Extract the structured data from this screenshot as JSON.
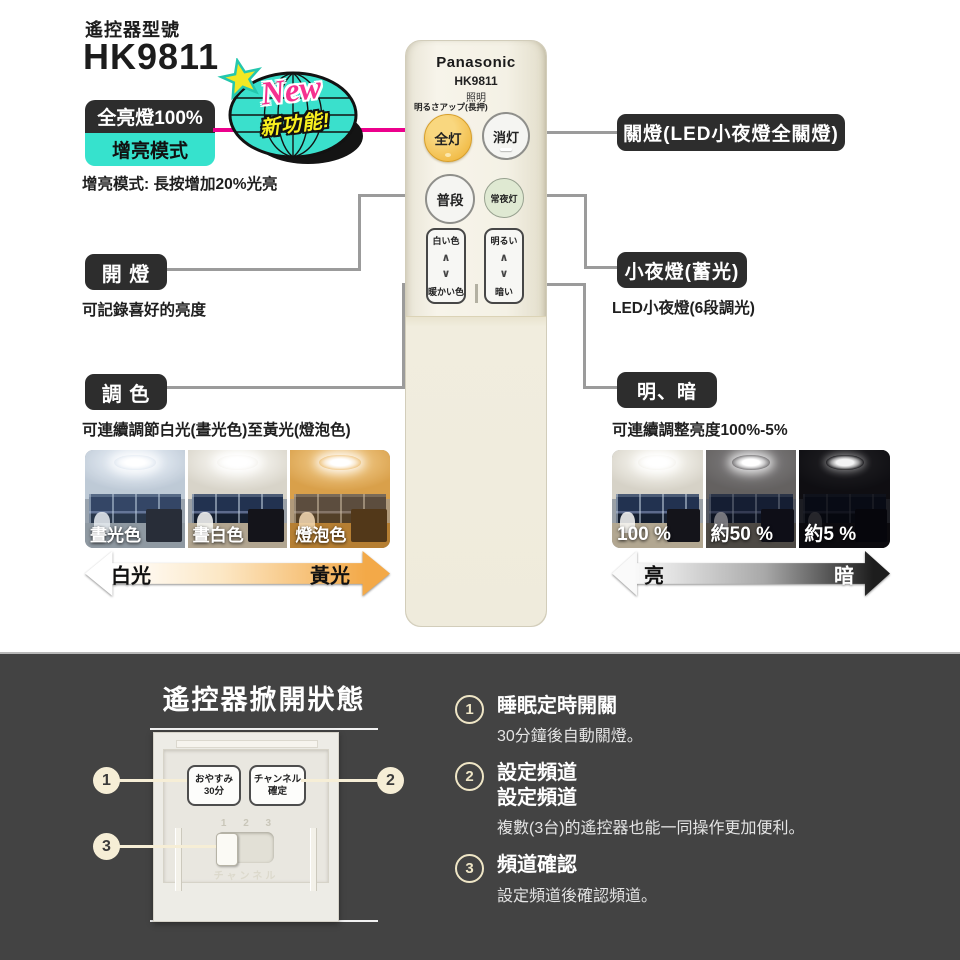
{
  "header": {
    "model_label": "遙控器型號",
    "model": "HK9811"
  },
  "new_badge": {
    "new_text": "New",
    "feature_text": "新功能!"
  },
  "left_callouts": {
    "full_light": "全亮燈100%",
    "boost_mode": "增亮模式",
    "boost_note": "增亮模式: 長按增加20%光亮",
    "on_label": "開 燈",
    "on_note": "可記錄喜好的亮度",
    "tone_label": "調 色",
    "tone_note": "可連續調節白光(晝光色)至黃光(燈泡色)",
    "photo_labels": [
      "晝光色",
      "晝白色",
      "燈泡色"
    ],
    "arrow_start": "白光",
    "arrow_end": "黃光"
  },
  "right_callouts": {
    "off_label": "關燈(LED小夜燈全關燈)",
    "night_label": "小夜燈(蓄光)",
    "night_note": "LED小夜燈(6段調光)",
    "dim_label": "明、暗",
    "dim_note": "可連續調整亮度100%-5%",
    "photo_labels": [
      "100 %",
      "約50 %",
      "約5 %"
    ],
    "arrow_start": "亮",
    "arrow_end": "暗"
  },
  "remote": {
    "brand": "Panasonic",
    "model": "HK9811",
    "product": "照明",
    "boost_hint": "明るさアップ(長押)",
    "buttons": {
      "all_on": "全灯",
      "off": "消灯",
      "normal": "普段",
      "night": "常夜灯",
      "white": "白い色",
      "warm": "暖かい色",
      "bright": "明るい",
      "dark": "暗い"
    },
    "up_glyph": "∧",
    "down_glyph": "∨"
  },
  "bottom": {
    "title": "遙控器掀開狀態",
    "panel": {
      "sleep_line1": "おやすみ",
      "sleep_line2": "30分",
      "channel_line1": "チャンネル",
      "channel_line2": "確定",
      "slider_numbers": "1 2 3",
      "slider_caption": "チャンネル"
    },
    "markers": [
      "1",
      "2",
      "3"
    ],
    "items": [
      {
        "num": "1",
        "title": "睡眠定時開關",
        "sub": "30分鐘後自動關燈。"
      },
      {
        "num": "2",
        "title": "設定頻道",
        "title2": "設定頻道",
        "sub": "複數(3台)的遙控器也能一同操作更加便利。"
      },
      {
        "num": "3",
        "title": "頻道確認",
        "sub": "設定頻道後確認頻道。"
      }
    ]
  },
  "colors": {
    "accent_pink": "#ec008c",
    "accent_cyan": "#36e2cd",
    "tag_black": "#2d2d2d",
    "dark_bg": "#434343",
    "button_orange": "#f2bd4a",
    "night_green": "#dfe9d2",
    "cream": "#f6eed6",
    "connector_gray": "#9b9b9b"
  }
}
